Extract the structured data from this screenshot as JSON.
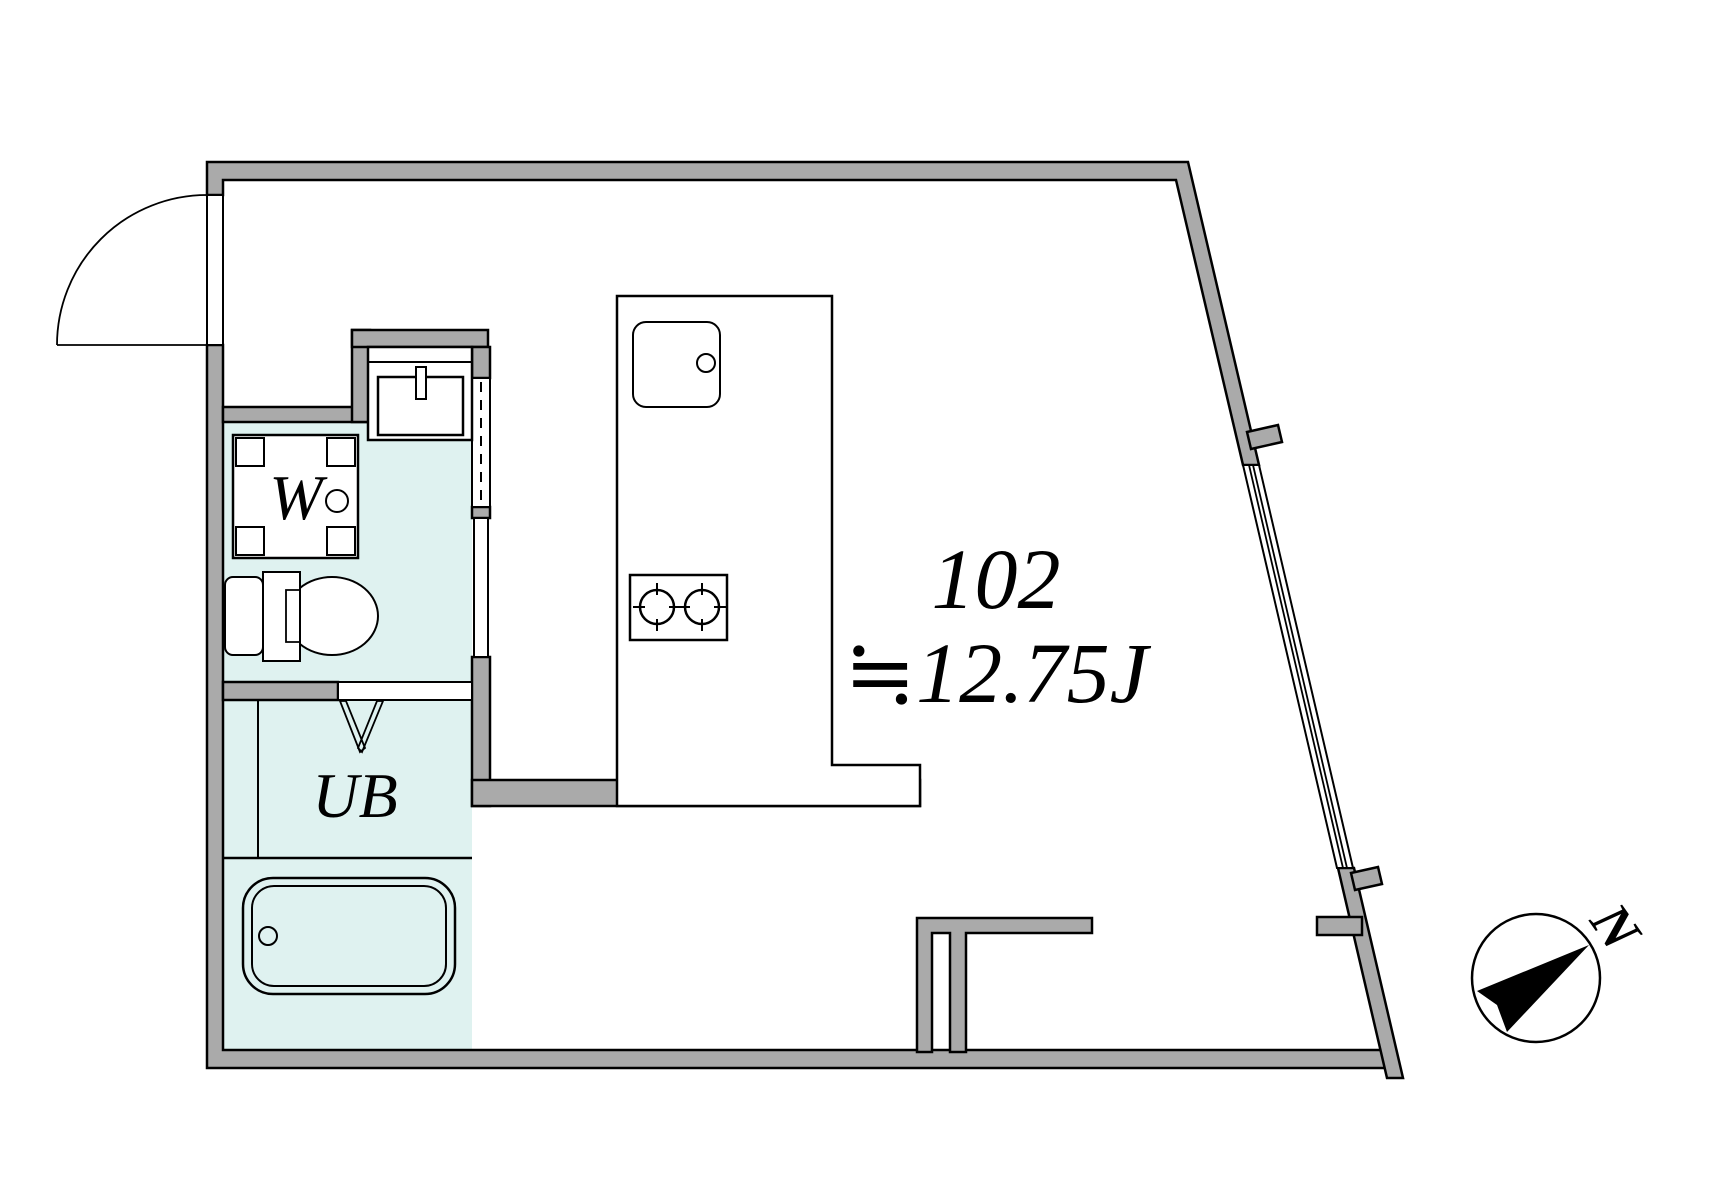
{
  "floorplan": {
    "unit_label": "102",
    "area_label": "≒12.75J",
    "labels": {
      "washer": "W",
      "unit_bath": "UB",
      "compass_north": "N"
    },
    "colors": {
      "wall_gray": "#aaaaaa",
      "wet_area_cyan": "#dff2f0",
      "outline_black": "#000000",
      "floor_white": "#ffffff"
    },
    "fixtures": [
      "entrance-door",
      "washing-machine-pan",
      "vanity-sink",
      "toilet",
      "unit-bath-folding-door",
      "bathtub",
      "kitchen-island-counter",
      "kitchen-sink",
      "two-burner-stove",
      "sliding-window",
      "compass-north-arrow"
    ]
  }
}
